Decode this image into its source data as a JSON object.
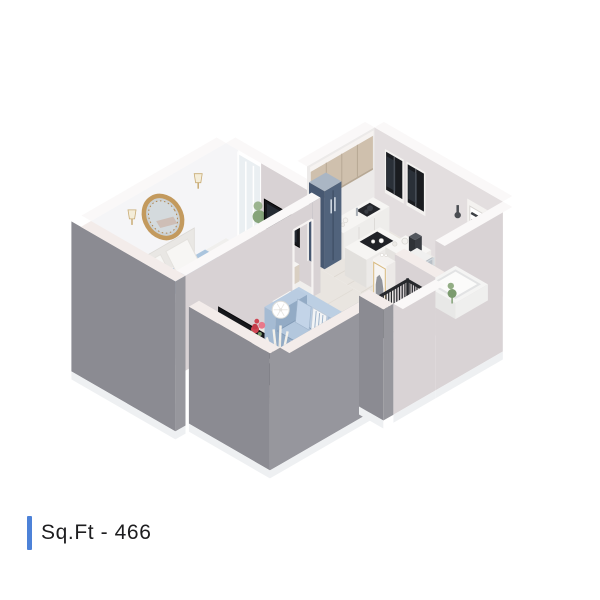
{
  "footer": {
    "label": "Sq.Ft - 466"
  },
  "colors": {
    "background": "#ffffff",
    "accentBar": "#4d82d8",
    "labelText": "#1d1d1f",
    "wallWhite": "#f5f5f7",
    "wallGreige": "#d8d2d4",
    "wallGreigeLight": "#d9d3d5",
    "wallOuterGray": "#8b8b92",
    "wallOuterGrayLight": "#97979d",
    "trimWhite": "#faf8f8",
    "trimPink": "#f3ecea",
    "baseWhite": "#eef0f2",
    "floorWood": "#e9e5e0",
    "floorWoodLight": "#ece8e3",
    "floorWoodLine": "#d9d3cb",
    "floorBedroom": "#f0efed",
    "floorRose": "#dcbcb6",
    "stairsGray": "#cdd0d3",
    "cabinetTan": "#cfc0ad",
    "cabinetTanDark": "#b7a894",
    "counterWhite": "#f6f5f3",
    "counterSide": "#ebe9e6",
    "fridgeNavy": "#51637c",
    "fridgeNavyDark": "#475871",
    "fridgeTop": "#aab6c4",
    "hobBlack": "#24262b",
    "tvBlack": "#16171b",
    "windowBlack": "#1a1c20",
    "louverSlat": "#3c3f44",
    "railBlack": "#26282c",
    "marble": "#b4b9bf",
    "marbleLight": "#c8ccd1",
    "tubWhite": "#f4f4f3",
    "sofaBlue": "#aabfd8",
    "sofaBlueDark": "#93acc7",
    "sofaBlueDeep": "#8099b5",
    "sofaLight": "#c3d4e8",
    "bedBlue": "#abc5de",
    "bedBlueDark": "#9fbad6",
    "bedBlueFront": "#94b1d0",
    "blanketWhite": "#f5f4f1",
    "pillowWhite": "#f7f6f4",
    "pillowPink": "#ef8d92",
    "headboard": "#e9e7e4",
    "wardrobeFace": "#cdc9ca",
    "wardrobeSide": "#dbd7d8",
    "consoleTan": "#cbb9a4",
    "mirrorGold": "#c39a5e",
    "mirrorGlass": "#ccd2d5",
    "rugBeige": "#e8decf",
    "rugLight": "#f0e8da",
    "tableGold": "#c9a063",
    "flowerRed": "#cf4653",
    "flowerPink": "#e8788a",
    "plantGreen": "#7b9b6e",
    "plantGreenLight": "#92ad84",
    "coralWhite": "#f2f0ea",
    "lampWhite": "#fbfbf9",
    "glassPale": "#e9eef1"
  }
}
